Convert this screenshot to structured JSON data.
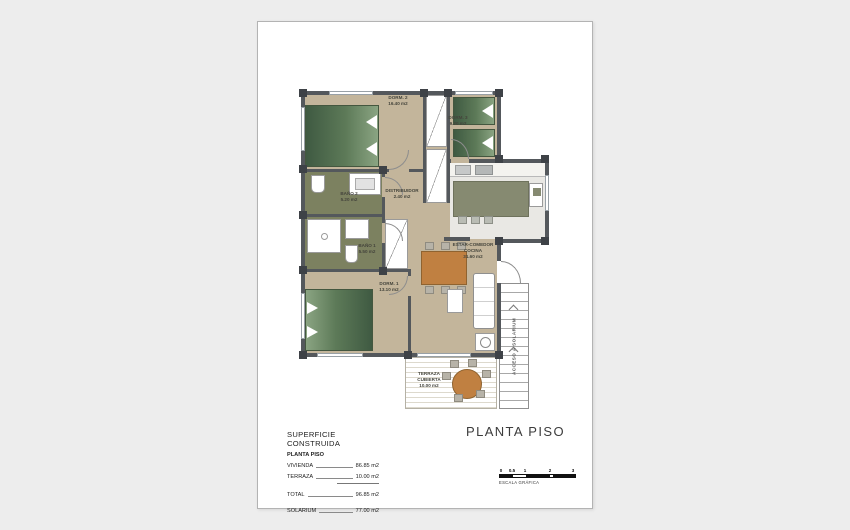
{
  "colors": {
    "page_background": "#ededed",
    "wall": "#54585c",
    "interior_floor": "#c3b59b",
    "bathroom_floor": "#7c8160",
    "kitchen_island": "#868a71",
    "bed_green": "#4e6b4e",
    "wood_orange": "#c08041"
  },
  "plan": {
    "rooms": {
      "dorm2": {
        "name": "DORM. 2",
        "area": "16.40 m2"
      },
      "dorm3": {
        "name": "DORM. 3",
        "area": "9.20 m2"
      },
      "bano2": {
        "name": "BAÑO 2",
        "area": "5.20 m2"
      },
      "bano1": {
        "name": "BAÑO 1",
        "area": "5.50 m2"
      },
      "distribuidor": {
        "name": "DISTRIBUIDOR",
        "area": "2.40 m2"
      },
      "estar_comedor": {
        "line1": "ESTAR-COMEDOR",
        "line2": "COCINA",
        "area": "31.60 m2"
      },
      "dorm1": {
        "name": "DORM. 1",
        "area": "13.10 m2"
      },
      "terraza": {
        "line1": "TERRAZA",
        "line2": "CUBIERTA",
        "area": "10.00 m2"
      }
    },
    "stair_label": "ACCESO A SOLARIUM"
  },
  "summary": {
    "title": "SUPERFICIE CONSTRUIDA",
    "subtitle": "PLANTA PISO",
    "rows": [
      {
        "label": "VIVIENDA",
        "value": "86.85 m2"
      },
      {
        "label": "TERRAZA",
        "value": "10.00 m2"
      },
      {
        "label": "TOTAL",
        "value": "96.85 m2"
      },
      {
        "label": "SOLARIUM",
        "value": "77.00 m2"
      }
    ]
  },
  "title_block": {
    "plan_title": "PLANTA PISO"
  },
  "scale_bar": {
    "ticks": [
      "0",
      "0.5",
      "1",
      "2",
      "3"
    ],
    "caption": "ESCALA GRÁFICA"
  }
}
